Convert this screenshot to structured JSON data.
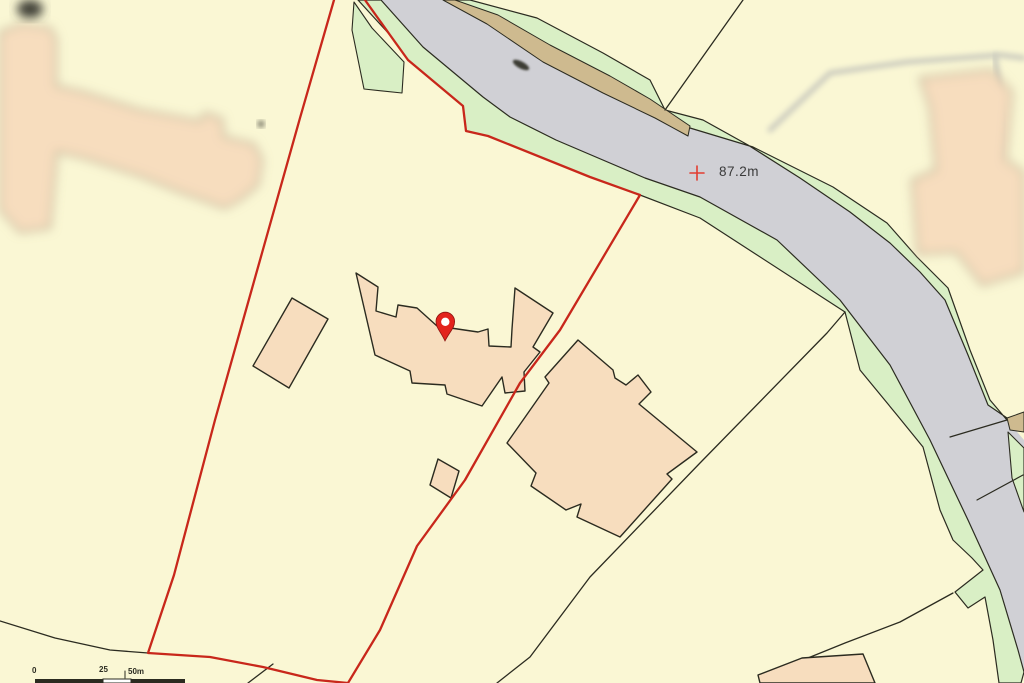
{
  "title": "Property location map",
  "palette": {
    "background": "#faf7d4",
    "road": "#d0d0d5",
    "verge": "#d9efc5",
    "track": "#ceba8f",
    "building": "#f7ddbe",
    "outline": "#2b2b20",
    "blur_outline": "#757560",
    "boundary_red": "#c8271b",
    "pin_red": "#e3231d",
    "pin_stroke": "#8e1410",
    "spot_red": "#e23c30",
    "text": "#3a3a3a",
    "path_grey": "#c9c9bd",
    "blob_dark": "#3c3c34"
  },
  "spot_height": {
    "label": "87.2m"
  },
  "scale_bar": {
    "label_0": "0",
    "label_25": "25",
    "label_50": "50m"
  },
  "pin": {
    "tip_x": 445,
    "tip_y": 341,
    "head_cx": 445.3,
    "head_cy": 321.8,
    "head_r": 9.3,
    "hole_r": 4.2
  },
  "features": [
    {
      "name": "road-surface",
      "kind": "area",
      "fill": "road",
      "points": "443,0 487,22 543,60 603,90 655,115 690,128 753,147 833,187 887,223 917,257 948,288 970,350 990,400 1007,420 1024,440 1024,676 1018,650 1000,590 968,520 930,440 890,365 840,300 777,240 700,197 645,178 556,140 510,117 483,97 423,47 381,0"
    },
    {
      "name": "road-verge-southwest",
      "kind": "area",
      "fill": "verge",
      "stroke": "outline",
      "w": 1.2,
      "points": "358,0 390,35 408,60 463,106 466,131 488,136 590,177 640,195 700,218 845,312 860,370 897,415 923,447 940,510 953,540 972,558 983,570 955,592 968,608 985,597 993,640 999,683 1021,683 1024,672 1018,650 1000,590 968,520 930,440 890,365 840,300 777,240 700,197 645,178 556,140 510,117 483,97 423,47 381,0"
    },
    {
      "name": "verge-wedge",
      "kind": "area",
      "fill": "verge",
      "stroke": "outline",
      "w": 1.1,
      "points": "354,2 372,28 404,62 402,93 364,89 352,30"
    },
    {
      "name": "road-verge-northeast",
      "kind": "area",
      "fill": "verge",
      "stroke": "outline",
      "w": 1.2,
      "points": "470,0 537,18 603,53 650,80 665,110 703,120 748,145 800,178 850,212 890,243 920,272 945,300 968,355 988,405 1007,418 1007,420 990,400 970,350 948,288 917,257 887,223 833,187 753,147 690,128 655,115 603,90 543,60 487,22 455,0"
    },
    {
      "name": "road-verge-northeast-lower",
      "kind": "area",
      "fill": "verge",
      "stroke": "outline",
      "w": 1.1,
      "points": "1008,432 1024,448 1024,512 1012,478"
    },
    {
      "name": "roadside-track",
      "kind": "area",
      "fill": "track",
      "stroke": "outline",
      "w": 1,
      "points": "443,0 487,24 543,62 603,93 655,118 688,136 690,126 650,99 610,76 550,45 498,15 455,0"
    },
    {
      "name": "roadside-track-lower",
      "kind": "area",
      "fill": "track",
      "stroke": "outline",
      "w": 1,
      "points": "1007,418 1024,412 1024,432 1010,430"
    },
    {
      "name": "track-smudge",
      "kind": "ellipse",
      "fill": "blob_dark",
      "cx": 521,
      "cy": 65,
      "rx": 9,
      "ry": 3.5,
      "rot": 28,
      "blur": "b1"
    },
    {
      "name": "building-northwest-blurred",
      "kind": "area",
      "fill": "building",
      "stroke": "blur_outline",
      "w": 1.5,
      "blur": "b5",
      "points": "0,32 22,24 50,28 56,38 56,86 83,92 140,110 200,121 205,113 222,119 224,137 254,144 262,160 258,185 240,200 225,208 180,192 140,176 84,158 57,152 50,228 20,232 0,210"
    },
    {
      "name": "building-northwest-blob",
      "kind": "ellipse",
      "fill": "blob_dark",
      "cx": 30,
      "cy": 9,
      "rx": 13,
      "ry": 9,
      "rot": 0,
      "blur": "b5"
    },
    {
      "name": "building-northwest-dot",
      "kind": "ellipse",
      "fill": "blob_dark",
      "cx": 261,
      "cy": 124,
      "rx": 3,
      "ry": 3,
      "rot": 0,
      "blur": "b4"
    },
    {
      "name": "footpath-blurred",
      "kind": "line",
      "stroke": "path_grey",
      "w": 5,
      "blur": "b4",
      "points": "770,130 830,73 907,62 1000,55 1024,58"
    },
    {
      "name": "footpath-branch-blurred",
      "kind": "line",
      "stroke": "path_grey",
      "w": 5,
      "blur": "b4",
      "points": "995,56 1003,120 998,165"
    },
    {
      "name": "building-east-blurred",
      "kind": "area",
      "fill": "building",
      "stroke": "blur_outline",
      "w": 1.5,
      "blur": "b5",
      "points": "920,78 992,70 1012,92 1006,160 1024,172 1024,272 982,285 956,252 918,254 912,180 936,170 930,108"
    },
    {
      "name": "field-line-north",
      "kind": "line",
      "stroke": "outline",
      "w": 1.3,
      "points": "743,0 665,110"
    },
    {
      "name": "field-line-east",
      "kind": "line",
      "stroke": "outline",
      "w": 1.3,
      "points": "845,312 827,333 700,463 590,577 530,657 497,683"
    },
    {
      "name": "field-line-southeast",
      "kind": "line",
      "stroke": "outline",
      "w": 1.3,
      "points": "953,593 900,622 845,643 803,660"
    },
    {
      "name": "field-line-southwest",
      "kind": "line",
      "stroke": "outline",
      "w": 1.3,
      "points": "0,621 55,638 110,650 148,653"
    },
    {
      "name": "field-line-south-short",
      "kind": "line",
      "stroke": "outline",
      "w": 1.3,
      "points": "248,683 273,664"
    },
    {
      "name": "road-crossing-line-upper",
      "kind": "line",
      "stroke": "outline",
      "w": 1.2,
      "points": "950,437 1007,420"
    },
    {
      "name": "road-crossing-line-lower",
      "kind": "line",
      "stroke": "outline",
      "w": 1.2,
      "points": "977,500 1023,475"
    },
    {
      "name": "outbuilding-west",
      "kind": "area",
      "fill": "building",
      "stroke": "outline",
      "w": 1.4,
      "points": "292,298 328,319 289,388 253,366"
    },
    {
      "name": "main-house",
      "kind": "area",
      "fill": "building",
      "stroke": "outline",
      "w": 1.4,
      "points": "356,273 378,287 376,311 396,317 398,305 417,308 437,326 478,332 488,329 489,346 511,347 512,329 515,288 553,313 533,347 540,352 524,372 525,391 505,393 502,377 482,406 447,394 445,385 412,383 410,371 375,355"
    },
    {
      "name": "shed-south",
      "kind": "area",
      "fill": "building",
      "stroke": "outline",
      "w": 1.4,
      "points": "438,459 459,471 451,498 430,485"
    },
    {
      "name": "building-east",
      "kind": "area",
      "fill": "building",
      "stroke": "outline",
      "w": 1.4,
      "points": "578,340 613,370 615,378 626,385 638,375 651,392 639,404 697,452 667,474 672,479 620,537 577,517 581,504 566,510 531,486 536,473 507,443 549,383 545,377"
    },
    {
      "name": "building-south",
      "kind": "area",
      "fill": "building",
      "stroke": "outline",
      "w": 1.4,
      "points": "758,675 802,658 863,654 875,683 760,683"
    },
    {
      "name": "parcel-boundary",
      "kind": "line",
      "stroke": "boundary_red",
      "w": 2.3,
      "points": "365,0 390,35 408,60 463,106 466,131 488,136 590,177 640,195 560,330 520,383 465,480 417,546 380,630 348,683 317,680 263,667 210,657 148,653 174,575 215,420 262,253 300,118 334,0"
    },
    {
      "name": "spot-height-cross-h",
      "kind": "line",
      "stroke": "spot_red",
      "w": 1.6,
      "points": "690,173 704,173"
    },
    {
      "name": "spot-height-cross-v",
      "kind": "line",
      "stroke": "spot_red",
      "w": 1.6,
      "points": "697,166 697,180"
    },
    {
      "name": "scale-bar-tick",
      "kind": "line",
      "stroke": "outline",
      "w": 1,
      "points": "125,671 125,678"
    },
    {
      "name": "scale-bar-segment-1",
      "kind": "rect",
      "fill": "outline",
      "x": 35,
      "y": 679,
      "wd": 68,
      "h": 4
    },
    {
      "name": "scale-bar-segment-2",
      "kind": "rect",
      "fill": "#ffffff",
      "stroke": "outline",
      "w": 1,
      "x": 103,
      "y": 679,
      "wd": 28,
      "h": 4
    },
    {
      "name": "scale-bar-segment-3",
      "kind": "rect",
      "fill": "outline",
      "x": 131,
      "y": 679,
      "wd": 54,
      "h": 4
    }
  ]
}
